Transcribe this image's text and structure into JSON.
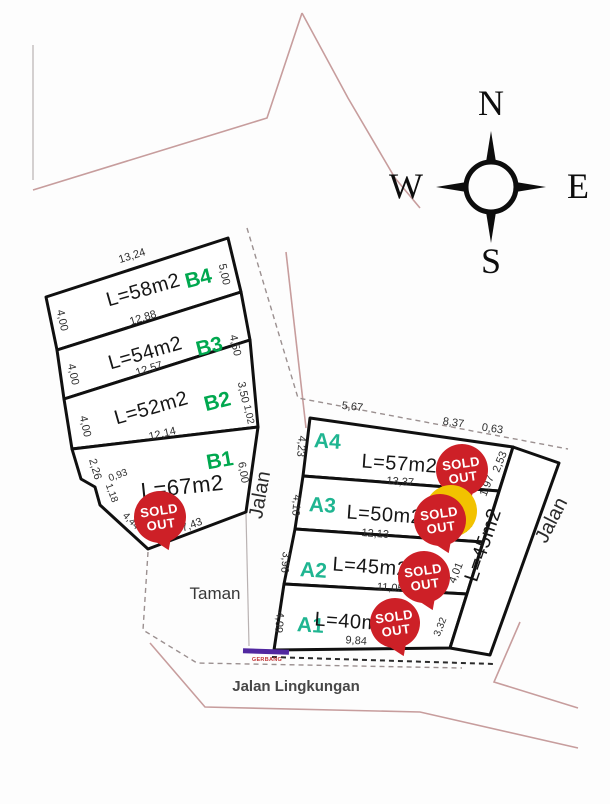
{
  "compass": {
    "north": "N",
    "east": "E",
    "west": "W",
    "south": "S"
  },
  "sold_badge": {
    "line1": "SOLD",
    "line2": "OUT"
  },
  "roads": {
    "jalan_mid": "Jalan",
    "jalan_right": "Jalan",
    "taman": "Taman",
    "jalan_lingkungan": "Jalan Lingkungan",
    "gerbang": "GERBANG"
  },
  "colors": {
    "lot_label_b": "#00a84f",
    "lot_label_a": "#1fb591",
    "sold_red": "#cd2027",
    "gerbang_bar": "#5128a0"
  },
  "parcels_b": [
    {
      "id": "B4",
      "area": "L=58m2",
      "dims": {
        "top": "13,24",
        "right": "5,00",
        "left": "4,00",
        "bottom": "12,88"
      }
    },
    {
      "id": "B3",
      "area": "L=54m2",
      "dims": {
        "right": "4,50",
        "left": "4,00",
        "bottom": "12,57"
      }
    },
    {
      "id": "B2",
      "area": "L=52m2",
      "dims": {
        "right": "3,50",
        "right2": "1,02",
        "left": "4,00",
        "bottom": "12,14"
      }
    },
    {
      "id": "B1",
      "area": "L=67m2",
      "dims": {
        "right": "6,00",
        "left": "2,26",
        "step1": "0,93",
        "step2": "1,18",
        "diag": "4,44",
        "bottom": "7,43"
      }
    }
  ],
  "parcels_a": [
    {
      "id": "A4",
      "area": "L=57m2",
      "dims": {
        "top1": "5,67",
        "top2": "8,37",
        "top3": "0,63",
        "left": "4,23",
        "right1": "2,53",
        "right2": "1,97",
        "bottom": "13,37"
      }
    },
    {
      "id": "A3",
      "area": "L=50m2",
      "dims": {
        "left": "4,10",
        "right": "4,00",
        "bottom": "12,13"
      }
    },
    {
      "id": "A2",
      "area": "L=45m2",
      "dims": {
        "left": "3,96",
        "right": "4,01",
        "bottom": "11,05"
      }
    },
    {
      "id": "A1",
      "area": "L=40m2",
      "dims": {
        "left": "4,09",
        "right": "3,32",
        "bottom": "9,84"
      }
    }
  ],
  "strip": {
    "area": "L=45m2"
  }
}
